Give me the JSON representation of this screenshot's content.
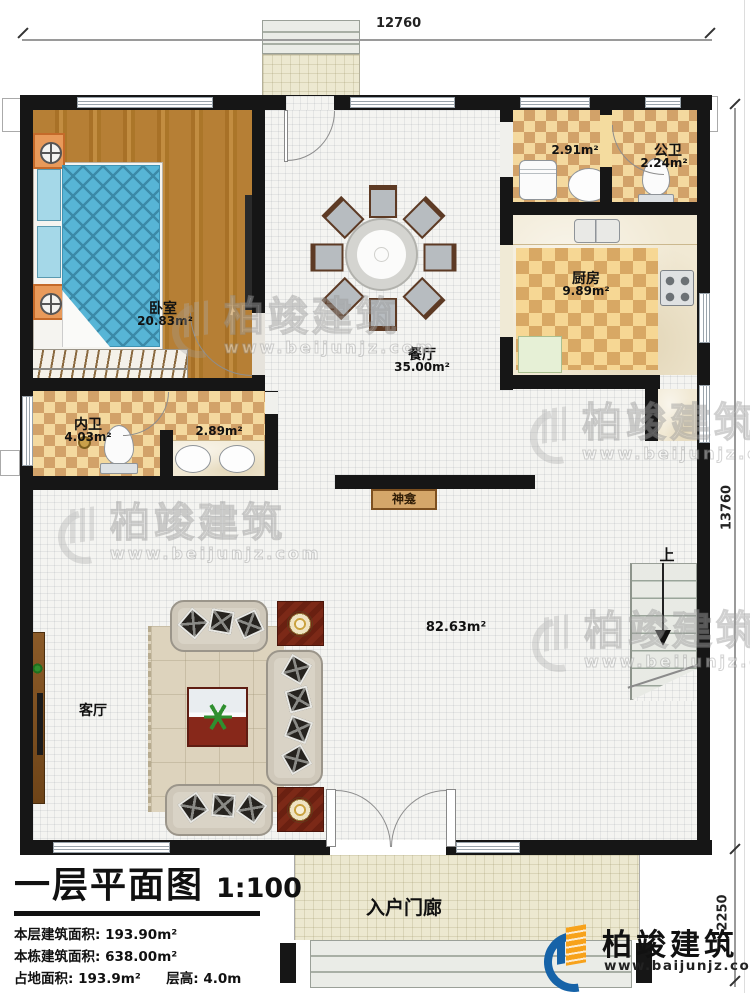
{
  "drawing": {
    "dimensions": {
      "top": "12760",
      "right_main": "13760",
      "right_porch": "2250"
    }
  },
  "rooms": {
    "bedroom": {
      "name": "卧室",
      "area": "20.83m²"
    },
    "private_bath": {
      "name": "内卫",
      "area": "4.03m²"
    },
    "vanity": {
      "area": "2.89m²"
    },
    "dining": {
      "name": "餐厅",
      "area": "35.00m²"
    },
    "laundry": {
      "area": "2.91m²"
    },
    "public_bath": {
      "name": "公卫",
      "area": "2.24m²"
    },
    "kitchen": {
      "name": "厨房",
      "area": "9.89m²"
    },
    "living": {
      "name": "客厅"
    },
    "great_room": {
      "area": "82.63m²"
    },
    "shrine": {
      "name": "神龛"
    },
    "stairs": {
      "direction": "上"
    },
    "porch": {
      "name": "入户门廊"
    }
  },
  "title_block": {
    "title": "一层平面图",
    "scale": "1:100",
    "line1_label": "本层建筑面积:",
    "line1_value": "193.90m²",
    "line2_label": "本栋建筑面积:",
    "line2_value": "638.00m²",
    "line3_label": "占地面积:",
    "line3_value": "193.9m²",
    "line3b_label": "层高:",
    "line3b_value": "4.0m"
  },
  "branding": {
    "logo_company": "柏竣建筑",
    "logo_website": "www.baijunjz.com",
    "watermark_company": "柏竣建筑",
    "watermark_website": "www.beijunjz.com"
  }
}
